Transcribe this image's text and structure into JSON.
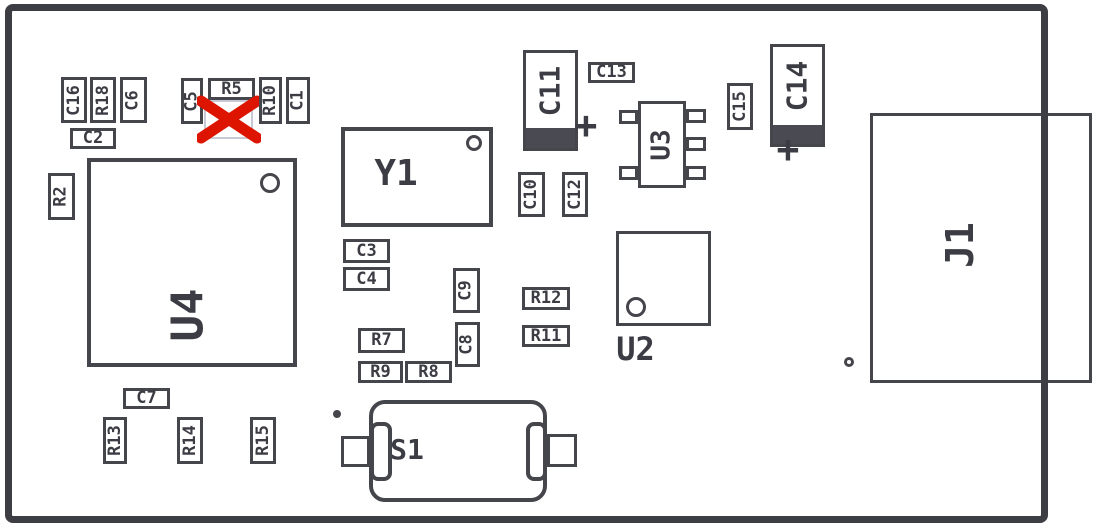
{
  "diagram": {
    "kind": "pcb-component-placement-top-view",
    "small_label_font": 17
  },
  "colors": {
    "outline": "#45454c",
    "text": "#3c3c44",
    "fill": "#ffffff",
    "board_edge": "#3d3d44",
    "red_x": "#dd1500",
    "ghost_outline": "#c8c9d6",
    "polarity_band": "#4a4a52"
  },
  "components": [
    {
      "ref": "C16",
      "type": "passive",
      "orient": "v",
      "x": 61,
      "y": 77,
      "w": 26,
      "h": 46
    },
    {
      "ref": "R18",
      "type": "passive",
      "orient": "v",
      "x": 90,
      "y": 77,
      "w": 26,
      "h": 46
    },
    {
      "ref": "C6",
      "type": "passive",
      "orient": "v",
      "x": 120,
      "y": 77,
      "w": 27,
      "h": 46
    },
    {
      "ref": "C2",
      "type": "passive",
      "orient": "h",
      "x": 70,
      "y": 128,
      "w": 46,
      "h": 21
    },
    {
      "ref": "C5",
      "type": "passive",
      "orient": "v",
      "x": 181,
      "y": 78,
      "w": 22,
      "h": 46
    },
    {
      "ref": "R5",
      "type": "passive",
      "orient": "h",
      "x": 208,
      "y": 78,
      "w": 47,
      "h": 22
    },
    {
      "ref": "R5X",
      "name": "not-populated-marker",
      "type": "crossed",
      "x": 197,
      "y": 94,
      "w": 64,
      "h": 50
    },
    {
      "ref": "R10",
      "type": "passive",
      "orient": "v",
      "x": 259,
      "y": 77,
      "w": 23,
      "h": 47
    },
    {
      "ref": "C1",
      "type": "passive",
      "orient": "v",
      "x": 286,
      "y": 77,
      "w": 24,
      "h": 47
    },
    {
      "ref": "R2",
      "type": "passive",
      "orient": "v",
      "x": 48,
      "y": 173,
      "w": 27,
      "h": 47
    },
    {
      "ref": "U4",
      "type": "ic",
      "orient": "v",
      "x": 87,
      "y": 158,
      "w": 210,
      "h": 209,
      "bw": 4,
      "font": 44,
      "label_dx": -4,
      "label_dy": 52,
      "circle": {
        "dx": 183,
        "dy": 25,
        "r": 10
      }
    },
    {
      "ref": "Y1",
      "type": "ic",
      "orient": "h",
      "x": 341,
      "y": 127,
      "w": 152,
      "h": 100,
      "bw": 4,
      "font": 36,
      "label_dx": -21,
      "label_dy": -3,
      "circle": {
        "dx": 133,
        "dy": 16,
        "r": 8
      }
    },
    {
      "ref": "C11",
      "type": "ecap",
      "orient": "v",
      "x": 523,
      "y": 50,
      "w": 55,
      "h": 101,
      "band": 20,
      "font": 28,
      "plus": {
        "dx": 63,
        "dy": 75
      }
    },
    {
      "ref": "C13",
      "type": "passive",
      "orient": "h",
      "x": 588,
      "y": 62,
      "w": 47,
      "h": 21
    },
    {
      "ref": "U3",
      "type": "sot",
      "orient": "v",
      "x": 638,
      "y": 101,
      "w": 48,
      "h": 87,
      "font": 26,
      "pins": [
        [
          -19,
          9,
          19,
          14
        ],
        [
          -19,
          65,
          19,
          14
        ],
        [
          48,
          8,
          20,
          14
        ],
        [
          48,
          36,
          20,
          14
        ],
        [
          48,
          65,
          20,
          14
        ]
      ]
    },
    {
      "ref": "C15",
      "type": "passive",
      "orient": "v",
      "x": 727,
      "y": 83,
      "w": 26,
      "h": 47
    },
    {
      "ref": "C14",
      "type": "ecap",
      "orient": "v",
      "x": 770,
      "y": 44,
      "w": 55,
      "h": 103,
      "band": 19,
      "font": 28,
      "plus": {
        "dx": 18,
        "dy": 105
      }
    },
    {
      "ref": "C10",
      "type": "passive",
      "orient": "v",
      "x": 518,
      "y": 172,
      "w": 27,
      "h": 45
    },
    {
      "ref": "C12",
      "type": "passive",
      "orient": "v",
      "x": 562,
      "y": 172,
      "w": 26,
      "h": 45
    },
    {
      "ref": "C3",
      "type": "passive",
      "orient": "h",
      "x": 343,
      "y": 239,
      "w": 47,
      "h": 24
    },
    {
      "ref": "C4",
      "type": "passive",
      "orient": "h",
      "x": 343,
      "y": 267,
      "w": 47,
      "h": 24
    },
    {
      "ref": "C9",
      "type": "passive",
      "orient": "v",
      "x": 453,
      "y": 268,
      "w": 27,
      "h": 45
    },
    {
      "ref": "C8",
      "type": "passive",
      "orient": "v",
      "x": 455,
      "y": 322,
      "w": 25,
      "h": 45
    },
    {
      "ref": "R7",
      "type": "passive",
      "orient": "h",
      "x": 358,
      "y": 328,
      "w": 47,
      "h": 25
    },
    {
      "ref": "R9",
      "type": "passive",
      "orient": "h",
      "x": 358,
      "y": 361,
      "w": 45,
      "h": 22
    },
    {
      "ref": "R8",
      "type": "passive",
      "orient": "h",
      "x": 405,
      "y": 361,
      "w": 47,
      "h": 22
    },
    {
      "ref": "R12",
      "type": "passive",
      "orient": "h",
      "x": 522,
      "y": 287,
      "w": 48,
      "h": 23
    },
    {
      "ref": "R11",
      "type": "passive",
      "orient": "h",
      "x": 522,
      "y": 325,
      "w": 48,
      "h": 22
    },
    {
      "ref": "U2",
      "type": "ic",
      "orient": "h",
      "x": 616,
      "y": 231,
      "w": 95,
      "h": 95,
      "bw": 3,
      "font": 32,
      "label_dx": -28,
      "label_dy": 70,
      "circle": {
        "dx": 20,
        "dy": 76,
        "r": 10
      }
    },
    {
      "ref": "J1",
      "type": "ic",
      "orient": "v",
      "x": 870,
      "y": 113,
      "w": 222,
      "h": 270,
      "bw": 3,
      "font": 38,
      "label_dx": -21,
      "label_dy": -3
    },
    {
      "ref": "J1DOT",
      "name": "j1-pin1-dot",
      "type": "dot",
      "x": 849,
      "y": 362,
      "r": 5,
      "filled": false
    },
    {
      "ref": "C7",
      "type": "passive",
      "orient": "h",
      "x": 123,
      "y": 388,
      "w": 47,
      "h": 21
    },
    {
      "ref": "R13",
      "type": "passive",
      "orient": "v",
      "x": 103,
      "y": 417,
      "w": 24,
      "h": 47
    },
    {
      "ref": "R14",
      "type": "passive",
      "orient": "v",
      "x": 177,
      "y": 417,
      "w": 26,
      "h": 47
    },
    {
      "ref": "R15",
      "type": "passive",
      "orient": "v",
      "x": 250,
      "y": 417,
      "w": 26,
      "h": 47
    },
    {
      "ref": "S1DOT",
      "name": "s1-orientation-dot",
      "type": "dot",
      "x": 337,
      "y": 414,
      "r": 4,
      "filled": true
    },
    {
      "ref": "S1",
      "type": "switch",
      "x": 341,
      "y": 400,
      "w": 236,
      "h": 102,
      "font": 28,
      "label_dx": -52,
      "label_dy": -1,
      "parts": {
        "tab_left": [
          0,
          36,
          29,
          31
        ],
        "body": [
          28,
          0,
          178,
          102
        ],
        "tab_right": [
          206,
          34,
          30,
          33
        ],
        "pad_left": [
          29,
          22,
          22,
          59
        ],
        "pad_right": [
          185,
          22,
          21,
          59
        ]
      }
    }
  ]
}
